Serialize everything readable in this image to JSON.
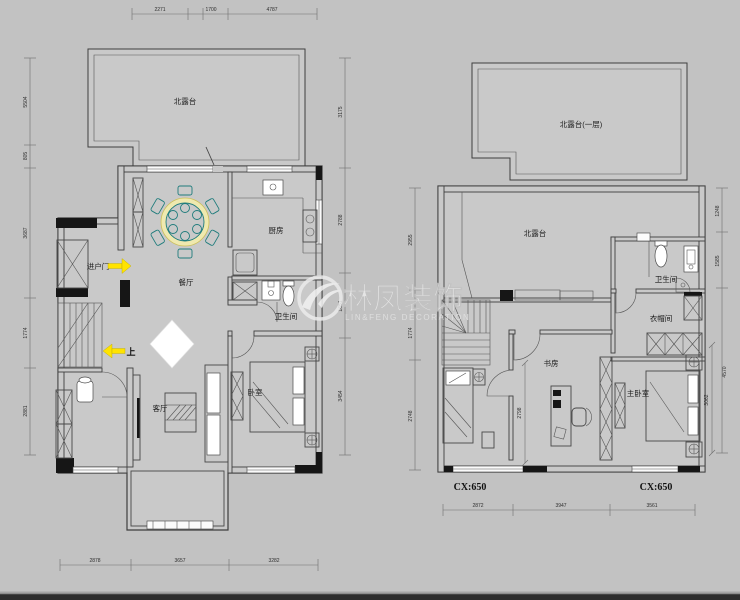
{
  "watermark": {
    "brand": "林凤装饰",
    "subtitle": "LIN&FENG DECORATION"
  },
  "floor1": {
    "rooms": {
      "terrace": "北露台",
      "dining": "餐厅",
      "kitchen": "厨房",
      "bathroom": "卫生间",
      "bedroom": "卧室",
      "living": "客厅"
    },
    "annotations": {
      "entry": "进户门",
      "up": "上"
    },
    "dims": {
      "top": [
        "2271",
        "1700",
        "4787"
      ],
      "left": [
        "5504",
        "805",
        "3687",
        "1774",
        "2881"
      ],
      "right": [
        "3175",
        "2788",
        "1651",
        "3454"
      ],
      "bottom": [
        "2878",
        "3657",
        "3282"
      ]
    }
  },
  "floor2": {
    "rooms": {
      "roof_terrace": "北露台(一层)",
      "terrace": "北露台",
      "bathroom": "卫生间",
      "cloakroom": "衣帽间",
      "study": "书房",
      "master_bedroom": "主卧室"
    },
    "window_labels": {
      "left": "CX:650",
      "right": "CX:650"
    },
    "dims": {
      "left": [
        "2955",
        "1774",
        "2748"
      ],
      "right": [
        "1248",
        "1585",
        "4570",
        "3062"
      ],
      "bottom": [
        "2872",
        "3947",
        "3561"
      ],
      "study": "2798"
    }
  },
  "colors": {
    "background": "#c2c2c2",
    "arrow": "#ffe300",
    "dining_teal": "#1f7c7c"
  }
}
